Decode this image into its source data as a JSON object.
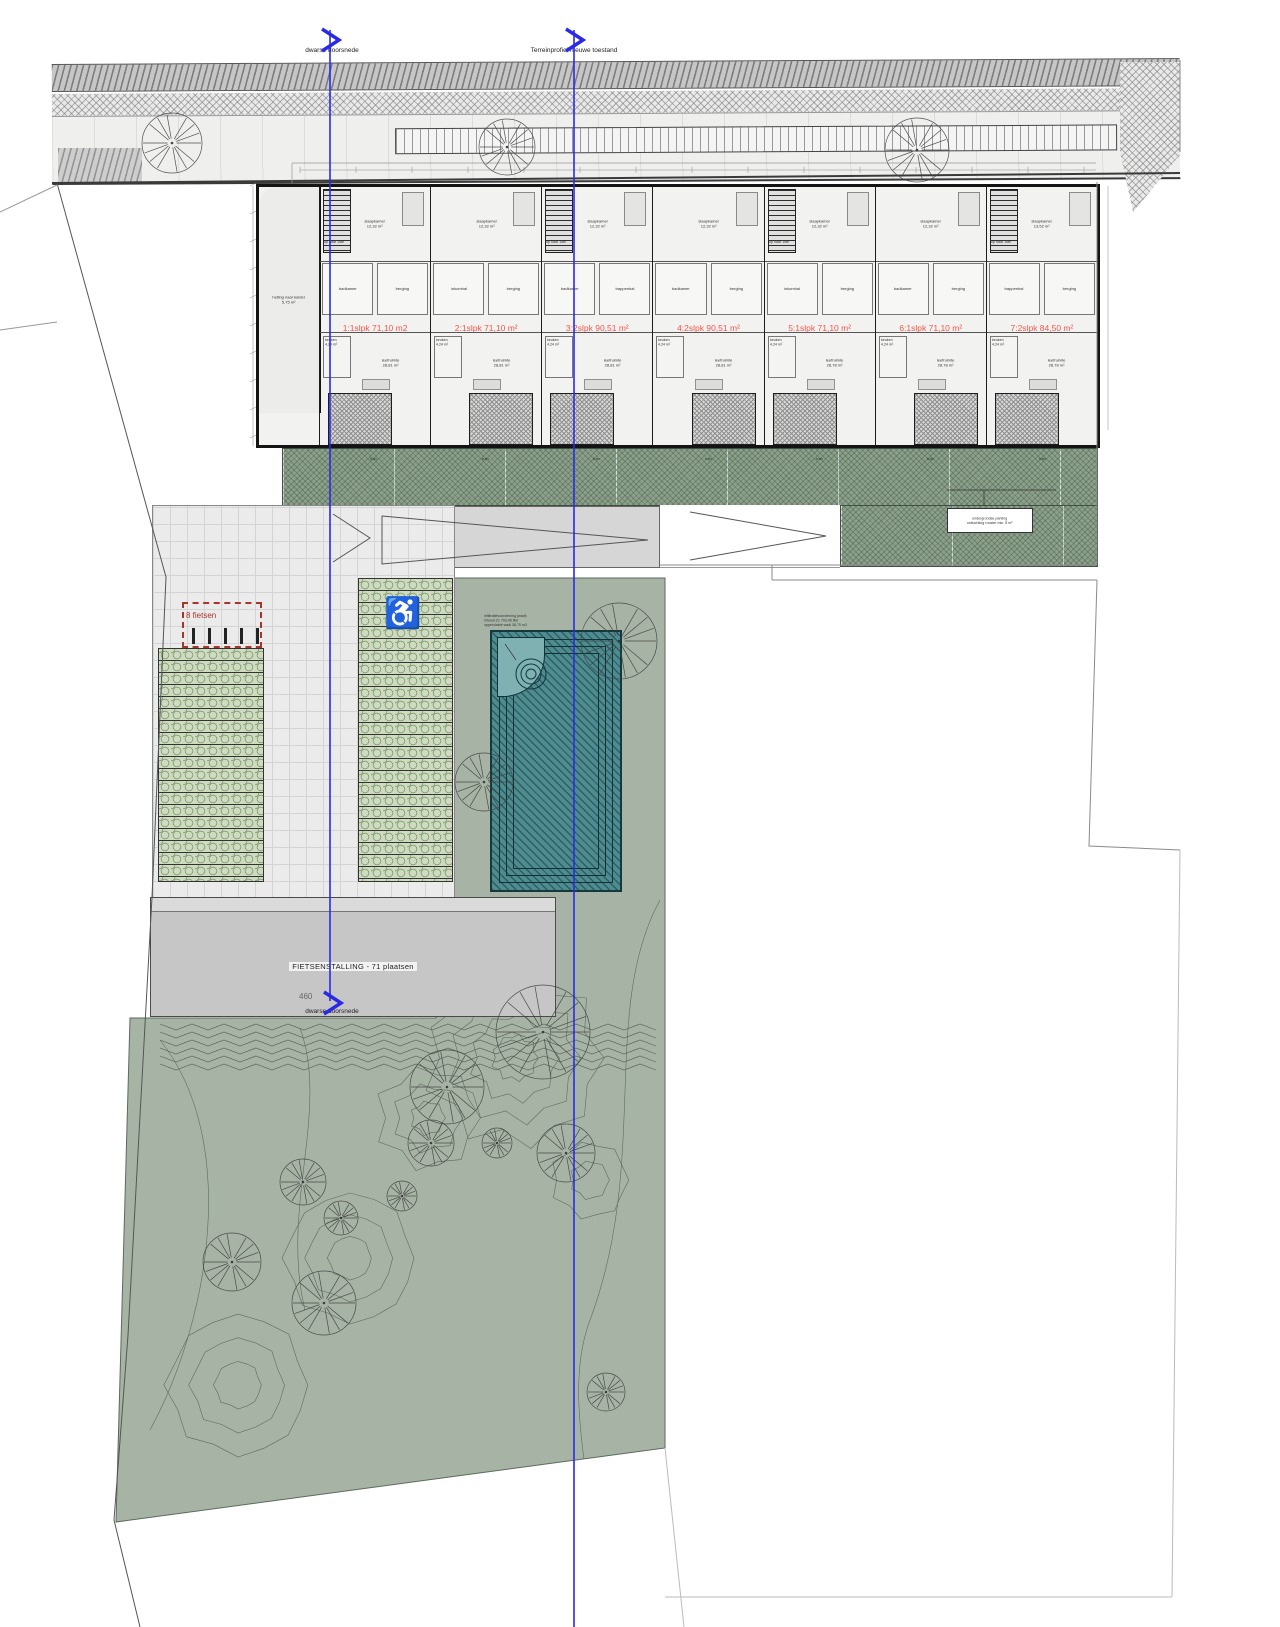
{
  "section_markers": {
    "top_left_label": "dwarse doorsnede",
    "top_right_label": "Terreinprofiel nieuwe toestand",
    "bottom_label": "dwarse doorsnede"
  },
  "colors": {
    "section_line": "#2a2ae6",
    "unit_label": "#f4564e",
    "green_band": "#8da08b",
    "garden": "#a7b4a5",
    "wadi": "#4f8c90",
    "grass_paver": "#cedbc0",
    "bike_roof": "#c6c6c6",
    "red_dashed_box": "#a8342c"
  },
  "building": {
    "annex": {
      "name": "helling naar kelder",
      "area": "5,75 m²"
    },
    "stair_label": "op naar 1ste",
    "units": [
      {
        "area_label": "1:1slpk 71,10 m2",
        "bedroom": "slaapkamer",
        "bedroom_area": "12,32 m²",
        "room_a": "badkamer",
        "room_b": "berging",
        "kitchen": "keuken",
        "kitchen_area": "4,24 m²",
        "living": "leefruimte",
        "living_area": "28,81 m²",
        "garden": "tuin"
      },
      {
        "area_label": "2:1slpk 71,10 m²",
        "bedroom": "slaapkamer",
        "bedroom_area": "12,32 m²",
        "room_a": "inkomhal",
        "room_b": "berging",
        "kitchen": "keuken",
        "kitchen_area": "4,24 m²",
        "living": "leefruimte",
        "living_area": "28,81 m²",
        "garden": "tuin"
      },
      {
        "area_label": "3:2slpk 90,51 m²",
        "bedroom": "slaapkamer",
        "bedroom_area": "12,32 m²",
        "room_a": "badkamer",
        "room_b": "trappenhal",
        "kitchen": "keuken",
        "kitchen_area": "4,24 m²",
        "living": "leefruimte",
        "living_area": "28,81 m²",
        "garden": "tuin"
      },
      {
        "area_label": "4:2slpk 90,51 m²",
        "bedroom": "slaapkamer",
        "bedroom_area": "12,32 m²",
        "room_a": "badkamer",
        "room_b": "berging",
        "kitchen": "keuken",
        "kitchen_area": "4,24 m²",
        "living": "leefruimte",
        "living_area": "28,81 m²",
        "garden": "tuin"
      },
      {
        "area_label": "5:1slpk 71,10 m²",
        "bedroom": "slaapkamer",
        "bedroom_area": "12,32 m²",
        "room_a": "inkomhal",
        "room_b": "berging",
        "kitchen": "keuken",
        "kitchen_area": "4,24 m²",
        "living": "leefruimte",
        "living_area": "28,78 m²",
        "garden": "tuin"
      },
      {
        "area_label": "6:1slpk 71,10 m²",
        "bedroom": "slaapkamer",
        "bedroom_area": "12,32 m²",
        "room_a": "badkamer",
        "room_b": "berging",
        "kitchen": "keuken",
        "kitchen_area": "4,24 m²",
        "living": "leefruimte",
        "living_area": "28,78 m²",
        "garden": "tuin"
      },
      {
        "area_label": "7:2slpk 84,50 m²",
        "bedroom": "slaapkamer",
        "bedroom_area": "13,52 m²",
        "room_a": "trappenhal",
        "room_b": "berging",
        "kitchen": "keuken",
        "kitchen_area": "4,24 m²",
        "living": "leefruimte",
        "living_area": "28,78 m²",
        "garden": "tuin"
      }
    ]
  },
  "site": {
    "bike_storage_label": "FIETSENSTALLING - 71 plaatsen",
    "parking_note": {
      "line1": "ondergrondse parking",
      "line2": "ontluchting rooster min. 8 m²"
    },
    "wadi_note": {
      "line1": "infiltratievoorziening (wadi)",
      "line2": "inhoud 21 703,40 liter",
      "line3": "oppervlakte wadi 36,70 m2"
    },
    "ramp_label": "bank",
    "bike_box_label": "8 fietsen",
    "dim_label": "460"
  },
  "icons": {
    "accessible_parking_glyph": "♿",
    "accessible_parking": "wheelchair-icon",
    "tree": "tree-icon",
    "section_arrow": "section-arrow-icon"
  }
}
